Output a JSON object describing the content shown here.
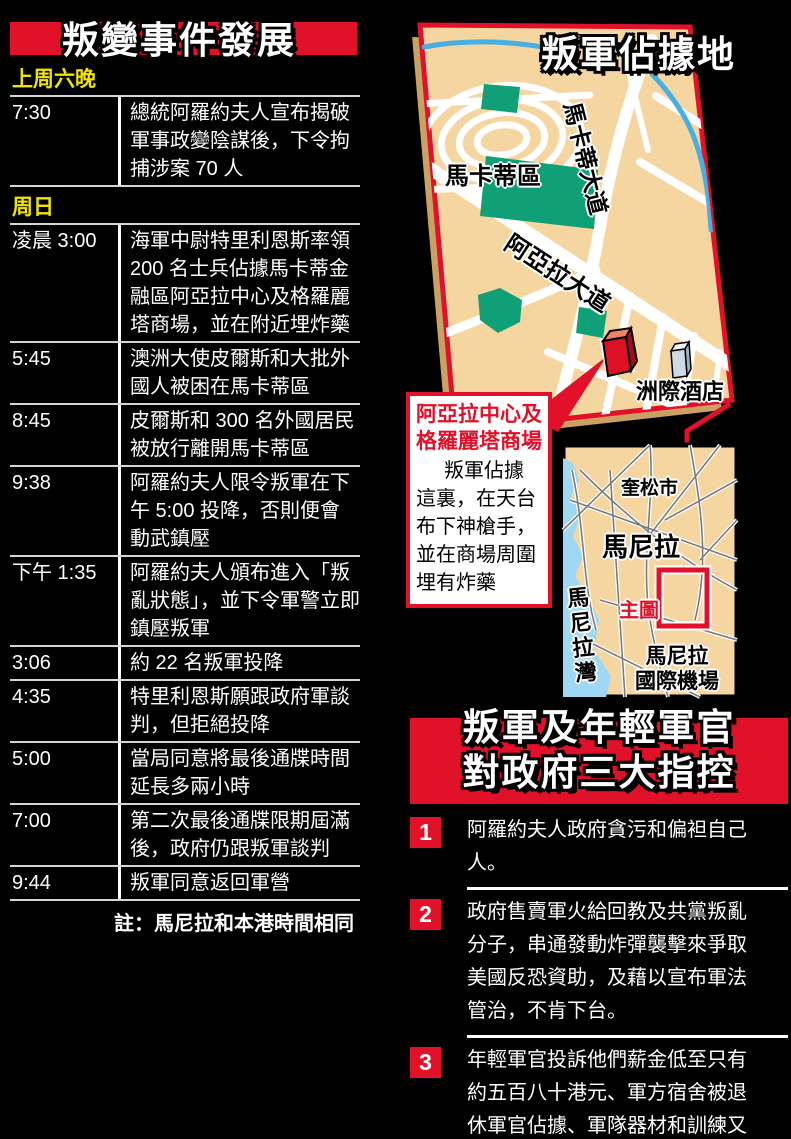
{
  "colors": {
    "red": "#e11129",
    "yellow": "#f0e400",
    "tan": "#f5d5a0",
    "tan_dark": "#c9a263",
    "green": "#0fa077",
    "water": "#9fd8f2",
    "river": "#49aee0",
    "line": "#d6d6d6"
  },
  "timeline": {
    "title": "叛變事件發展",
    "note": "註：馬尼拉和本港時間相同",
    "rows": [
      {
        "type": "section",
        "label": "上周六晚"
      },
      {
        "type": "entry",
        "time": "7:30",
        "text": "總統阿羅約夫人宣布揭破軍事政變陰謀後，下令拘捕涉案 70 人"
      },
      {
        "type": "section",
        "label": "周日"
      },
      {
        "type": "entry",
        "time": "凌晨 3:00",
        "text": "海軍中尉特里利恩斯率領 200 名士兵佔據馬卡蒂金融區阿亞拉中心及格羅麗塔商場，並在附近埋炸藥"
      },
      {
        "type": "entry",
        "time": "5:45",
        "text": "澳洲大使皮爾斯和大批外國人被困在馬卡蒂區"
      },
      {
        "type": "entry",
        "time": "8:45",
        "text": "皮爾斯和 300 名外國居民被放行離開馬卡蒂區"
      },
      {
        "type": "entry",
        "time": "9:38",
        "text": "阿羅約夫人限令叛軍在下午 5:00 投降，否則便會動武鎮壓"
      },
      {
        "type": "entry",
        "time": "下午 1:35",
        "text": "阿羅約夫人頒布進入「叛亂狀態」，並下令軍警立即鎮壓叛軍"
      },
      {
        "type": "entry",
        "time": "3:06",
        "text": "約 22 名叛軍投降"
      },
      {
        "type": "entry",
        "time": "4:35",
        "text": "特里利恩斯願跟政府軍談判，但拒絕投降"
      },
      {
        "type": "entry",
        "time": "5:00",
        "text": "當局同意將最後通牒時間延長多兩小時"
      },
      {
        "type": "entry",
        "time": "7:00",
        "text": "第二次最後通牒限期屆滿後，政府仍跟叛軍談判"
      },
      {
        "type": "entry",
        "time": "9:44",
        "text": "叛軍同意返回軍營"
      }
    ]
  },
  "map": {
    "title": "叛軍佔據地",
    "district_label": "馬卡蒂區",
    "makati_ave": "馬卡蒂大道",
    "ayala_ave": "阿亞拉大道",
    "hotel_label": "洲際酒店",
    "callout": {
      "title": "阿亞拉中心及格羅麗塔商場",
      "body": "叛軍佔據這裏，在天台布下神槍手，並在商場周圍埋有炸藥"
    },
    "inset": {
      "quezon": "奎松市",
      "manila": "馬尼拉",
      "bay": "馬尼拉灣",
      "main_map": "主圖",
      "airport_line1": "馬尼拉",
      "airport_line2": "國際機場"
    }
  },
  "accusations": {
    "title_line1": "叛軍及年輕軍官",
    "title_line2": "對政府三大指控",
    "items": [
      {
        "num": "1",
        "text": "阿羅約夫人政府貪污和偏袒自己人。"
      },
      {
        "num": "2",
        "text": "政府售賣軍火給回教及共黨叛亂分子，串通發動炸彈襲擊來爭取美國反恐資助，及藉以宣布軍法管治，不肯下台。"
      },
      {
        "num": "3",
        "text": "年輕軍官投訴他們薪金低至只有約五百八十港元、軍方宿舍被退休軍官佔據、軍隊器材和訓練又嚴重不足。"
      }
    ]
  }
}
